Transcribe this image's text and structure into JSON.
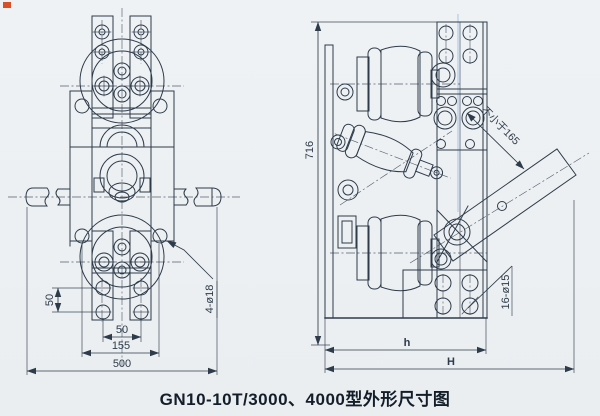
{
  "colors": {
    "paper": "#edf1f3",
    "ink": "#2e3b4a",
    "title_ink": "#141e2a",
    "scan_line": "#a9c3e2",
    "corner_mark": "#d94f28"
  },
  "title": "GN10-10T/3000、4000型外形尺寸图",
  "front_view": {
    "dim_hole_pitch_vertical": "50",
    "dim_hole_pitch_horizontal": "50",
    "dim_flange_hole_spacing": "155",
    "dim_overall_width": "500",
    "label_mounting_holes": "4-ø18"
  },
  "side_view": {
    "dim_overall_height": "716",
    "label_min_clearance": "不小于165",
    "label_mounting_holes": "16-ø15",
    "dim_frame_width": "h",
    "dim_overall_width": "H"
  }
}
